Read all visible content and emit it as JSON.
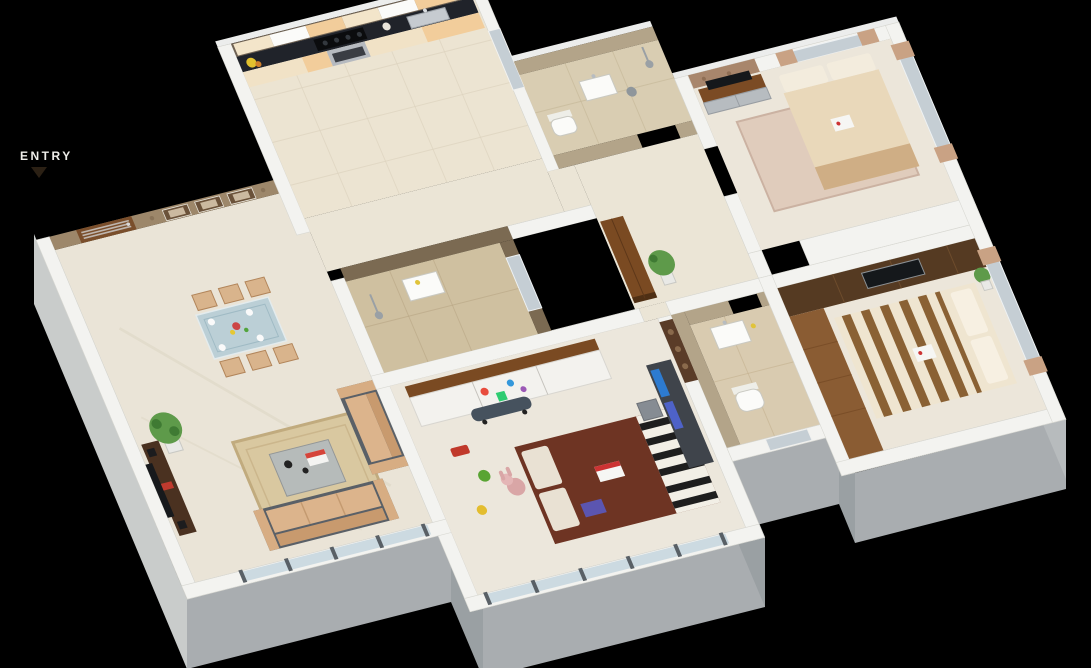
{
  "meta": {
    "description": "3D isometric dollhouse floor plan render of a 2BHK apartment on a black background",
    "view": "isometric-top",
    "background": "#000000"
  },
  "entry": {
    "label": "ENTRY",
    "arrow_direction": "down"
  },
  "palette": {
    "background": "#000000",
    "floor_marble": "#eae4d7",
    "floor_room": "#ece6da",
    "wall_top": "#f3f3f0",
    "wall_face": "#a9adb0",
    "wall_face_light": "#c9cccb",
    "wall_face_dark": "#9aa0a3",
    "stone_wall": "#9d876a",
    "accent_stone": "#a8866c",
    "door_wood": "#7a4e2b",
    "furniture_wood": "#7a4a22",
    "wardrobe_wood": "#553a22",
    "counter_top": "#20232a",
    "cabinet_cream": "#f1e2c6",
    "cabinet_peach": "#f2cd9b",
    "bath_tile_brown": "#7b6a52",
    "bath_tile_tan": "#b3a489",
    "bath_floor": "#cfc0a0",
    "sofa_beige": "#dcb48c",
    "sofa_base": "#5a6067",
    "kids_bed": "#6e3423",
    "bed_cream": "#e9d8ba",
    "bed_stripe": "#8a6134",
    "curtain": "#c9a284",
    "glass": "#b7cdd8",
    "window_glass": "#c5ced4",
    "plant_green": "#5e9a4a",
    "rug_living": "#d9c8a0",
    "rug_bedroom": "#e0ccbc",
    "deck_wood": "#8a5c33"
  },
  "rooms": [
    {
      "name": "living-dining",
      "items": [
        "entry-door",
        "stone-accent-wall",
        "wall-frames",
        "dining-table",
        "dining-chairs",
        "sofa-set",
        "coffee-table",
        "rug",
        "tv-cabinet",
        "plant",
        "glass-railing"
      ]
    },
    {
      "name": "kitchen",
      "items": [
        "upper-cabinets",
        "black-counter",
        "hob",
        "oven",
        "sink",
        "flowers",
        "window"
      ]
    },
    {
      "name": "common-bathroom",
      "items": [
        "washbasin",
        "shower",
        "window"
      ]
    },
    {
      "name": "passage",
      "items": [
        "plant",
        "wooden-cabinet",
        "open-shaft"
      ]
    },
    {
      "name": "toilet-bathroom",
      "items": [
        "washbasin",
        "toilet",
        "shower",
        "dustbin"
      ]
    },
    {
      "name": "bedroom-2",
      "items": [
        "bed",
        "pillows",
        "rug",
        "tv-unit",
        "stone-accent",
        "windows-with-curtains"
      ]
    },
    {
      "name": "kids-bedroom",
      "items": [
        "bed",
        "zebra-throw",
        "wardrobe-cartoon-doors",
        "study-desk",
        "chair",
        "skateboard",
        "toy-car",
        "teddy-bunny",
        "balcony-glass-railing"
      ]
    },
    {
      "name": "master-bedroom",
      "items": [
        "striped-bed",
        "wardrobe-tv-unit",
        "wooden-deck",
        "windows-with-curtains",
        "plant"
      ]
    },
    {
      "name": "master-bathroom",
      "items": [
        "washbasin",
        "toilet",
        "window"
      ]
    }
  ]
}
